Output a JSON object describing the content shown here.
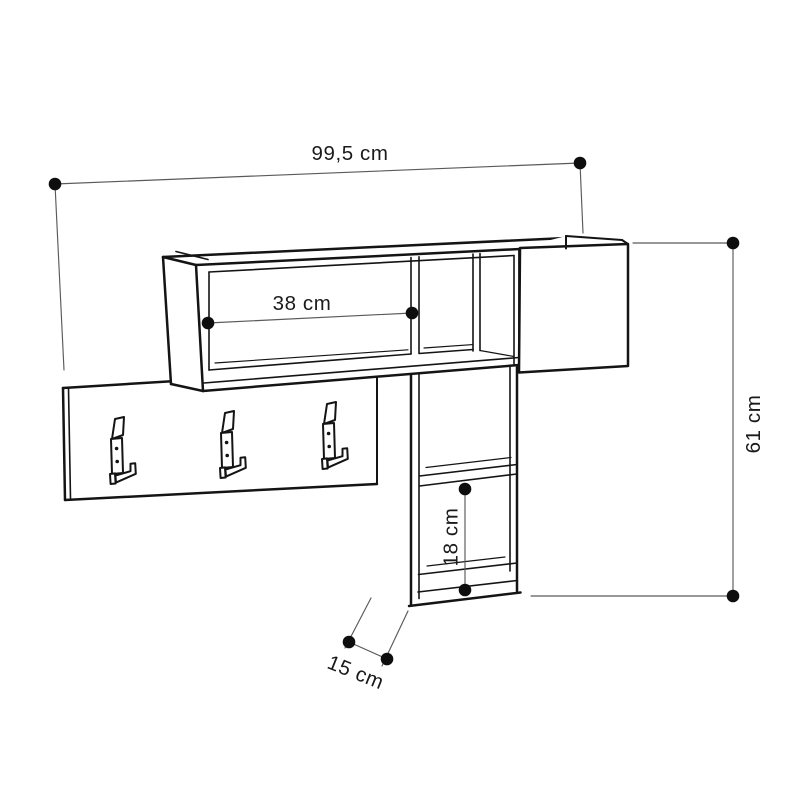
{
  "page": {
    "background_color": "#ffffff"
  },
  "drawing": {
    "kind": "furniture-technical-dimension-drawing",
    "subject": "wall-mounted coat rack shelf with hooks and cubby",
    "colors": {
      "outline": "#141414",
      "dimension_line": "#5a5a5a",
      "marker_dot": "#0e0e0e",
      "label_text": "#1a1a1a",
      "background": "#ffffff"
    },
    "hooks": {
      "count": 3,
      "icon": "coat-hook-icon"
    },
    "dimensions": {
      "overall_width": {
        "label": "99,5 cm",
        "value": 99.5,
        "unit": "cm",
        "orientation": "horizontal"
      },
      "shelf_opening_width": {
        "label": "38 cm",
        "value": 38,
        "unit": "cm",
        "orientation": "horizontal"
      },
      "overall_height": {
        "label": "61 cm",
        "value": 61,
        "unit": "cm",
        "orientation": "vertical"
      },
      "cubby_opening_height": {
        "label": "18 cm",
        "value": 18,
        "unit": "cm",
        "orientation": "vertical"
      },
      "side_depth": {
        "label": "15 cm",
        "value": 15,
        "unit": "cm",
        "orientation": "diagonal"
      }
    }
  }
}
